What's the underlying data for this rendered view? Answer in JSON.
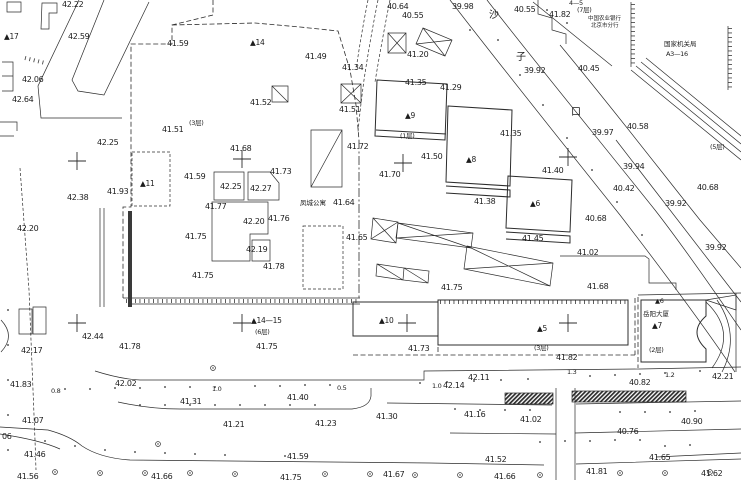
{
  "map_name": "cadastral-survey-site-plan",
  "colors": {
    "ink": "#2c2c2c",
    "background": "#ffffff"
  },
  "street_name_chars": "沙子口",
  "labels": [
    {
      "t": "42.22",
      "x": 62,
      "y": 1
    },
    {
      "t": "42.59",
      "x": 68,
      "y": 33
    },
    {
      "t": "41.59",
      "x": 167,
      "y": 40
    },
    {
      "t": "42.06",
      "x": 22,
      "y": 76
    },
    {
      "t": "42.64",
      "x": 12,
      "y": 96
    },
    {
      "t": "42.25",
      "x": 97,
      "y": 139
    },
    {
      "t": "41.51",
      "x": 162,
      "y": 126
    },
    {
      "t": "(3层)",
      "x": 189,
      "y": 120,
      "c": "fl",
      "n": "floor-count-label"
    },
    {
      "t": "▲17",
      "x": 4,
      "y": 33,
      "c": "bn",
      "n": "building-number-label"
    },
    {
      "t": "▲14",
      "x": 250,
      "y": 39,
      "c": "bn",
      "n": "building-number-label"
    },
    {
      "t": "41.49",
      "x": 305,
      "y": 53
    },
    {
      "t": "41.52",
      "x": 250,
      "y": 99
    },
    {
      "t": "40.64",
      "x": 387,
      "y": 3
    },
    {
      "t": "40.55",
      "x": 402,
      "y": 12
    },
    {
      "t": "39.98",
      "x": 452,
      "y": 3
    },
    {
      "t": "41.34",
      "x": 342,
      "y": 64
    },
    {
      "t": "41.20",
      "x": 407,
      "y": 51
    },
    {
      "t": "41.35",
      "x": 405,
      "y": 79
    },
    {
      "t": "41.29",
      "x": 440,
      "y": 84
    },
    {
      "t": "41.51",
      "x": 339,
      "y": 106
    },
    {
      "t": "41.72",
      "x": 347,
      "y": 143
    },
    {
      "t": "40.55",
      "x": 514,
      "y": 6
    },
    {
      "t": "41.82",
      "x": 549,
      "y": 11
    },
    {
      "t": "4—5",
      "x": 569,
      "y": 0,
      "c": "fl",
      "n": "building-number-label"
    },
    {
      "t": "(7层)",
      "x": 577,
      "y": 7,
      "c": "fl",
      "n": "floor-count-label"
    },
    {
      "t": "中国农业银行",
      "x": 588,
      "y": 17,
      "c": "s5",
      "n": "building-name-label"
    },
    {
      "t": "北京市分行",
      "x": 591,
      "y": 24,
      "c": "s5",
      "n": "building-name-label"
    },
    {
      "t": "国家机关局",
      "x": 664,
      "y": 41,
      "c": "s6",
      "n": "building-name-label"
    },
    {
      "t": "A3—16",
      "x": 666,
      "y": 51,
      "c": "fl",
      "n": "building-number-label"
    },
    {
      "t": "40.45",
      "x": 578,
      "y": 65
    },
    {
      "t": "39.92",
      "x": 524,
      "y": 67
    },
    {
      "t": "沙",
      "x": 489,
      "y": 11,
      "c": "s10",
      "n": "street-name-char"
    },
    {
      "t": "子",
      "x": 516,
      "y": 53,
      "c": "s10",
      "n": "street-name-char"
    },
    {
      "t": "口",
      "x": 571,
      "y": 108,
      "c": "s10",
      "n": "street-name-char"
    },
    {
      "t": "40.58",
      "x": 627,
      "y": 123
    },
    {
      "t": "39.97",
      "x": 592,
      "y": 129
    },
    {
      "t": "(5层)",
      "x": 710,
      "y": 144,
      "c": "fl",
      "n": "floor-count-label"
    },
    {
      "t": "39.94",
      "x": 623,
      "y": 163
    },
    {
      "t": "40.42",
      "x": 613,
      "y": 185
    },
    {
      "t": "40.68",
      "x": 697,
      "y": 184
    },
    {
      "t": "39.92",
      "x": 665,
      "y": 200
    },
    {
      "t": "40.68",
      "x": 585,
      "y": 215
    },
    {
      "t": "39.92",
      "x": 705,
      "y": 244
    },
    {
      "t": "41.02",
      "x": 577,
      "y": 249
    },
    {
      "t": "41.68",
      "x": 587,
      "y": 283
    },
    {
      "t": "41.68",
      "x": 230,
      "y": 145
    },
    {
      "t": "41.73",
      "x": 270,
      "y": 168
    },
    {
      "t": "41.59",
      "x": 184,
      "y": 173
    },
    {
      "t": "42.25",
      "x": 220,
      "y": 183
    },
    {
      "t": "42.27",
      "x": 250,
      "y": 185
    },
    {
      "t": "41.77",
      "x": 205,
      "y": 203
    },
    {
      "t": "42.20",
      "x": 243,
      "y": 218
    },
    {
      "t": "41.75",
      "x": 185,
      "y": 233
    },
    {
      "t": "42.19",
      "x": 246,
      "y": 246
    },
    {
      "t": "41.76",
      "x": 268,
      "y": 215
    },
    {
      "t": "41.78",
      "x": 263,
      "y": 263
    },
    {
      "t": "41.75",
      "x": 192,
      "y": 272
    },
    {
      "t": "41.93",
      "x": 107,
      "y": 188
    },
    {
      "t": "▲11",
      "x": 140,
      "y": 180,
      "c": "bn",
      "n": "building-number-label"
    },
    {
      "t": "42.38",
      "x": 67,
      "y": 194
    },
    {
      "t": "42.20",
      "x": 17,
      "y": 225
    },
    {
      "t": "凤城公寓",
      "x": 300,
      "y": 200,
      "c": "s6",
      "n": "building-name-label"
    },
    {
      "t": "41.64",
      "x": 333,
      "y": 199
    },
    {
      "t": "41.65",
      "x": 346,
      "y": 234
    },
    {
      "t": "41.70",
      "x": 379,
      "y": 171
    },
    {
      "t": "41.50",
      "x": 421,
      "y": 153
    },
    {
      "t": "(1层)",
      "x": 400,
      "y": 133,
      "c": "fl",
      "n": "floor-count-label"
    },
    {
      "t": "▲9",
      "x": 405,
      "y": 112,
      "c": "bn",
      "n": "building-number-label"
    },
    {
      "t": "▲8",
      "x": 466,
      "y": 156,
      "c": "bn",
      "n": "building-number-label"
    },
    {
      "t": "41.38",
      "x": 474,
      "y": 198
    },
    {
      "t": "▲6",
      "x": 530,
      "y": 200,
      "c": "bn",
      "n": "building-number-label"
    },
    {
      "t": "41.40",
      "x": 542,
      "y": 167
    },
    {
      "t": "41.45",
      "x": 522,
      "y": 235
    },
    {
      "t": "41.35",
      "x": 500,
      "y": 130
    },
    {
      "t": "41.75",
      "x": 441,
      "y": 284
    },
    {
      "t": "42.17",
      "x": 21,
      "y": 347
    },
    {
      "t": "42.44",
      "x": 82,
      "y": 333
    },
    {
      "t": "41.78",
      "x": 119,
      "y": 343
    },
    {
      "t": "41.83",
      "x": 10,
      "y": 381
    },
    {
      "t": "42.02",
      "x": 115,
      "y": 380
    },
    {
      "t": "0.8",
      "x": 51,
      "y": 388,
      "c": "fl",
      "n": "distance-label"
    },
    {
      "t": "1.0",
      "x": 212,
      "y": 386,
      "c": "fl",
      "n": "distance-label"
    },
    {
      "t": "41.31",
      "x": 180,
      "y": 398
    },
    {
      "t": "▲14—15",
      "x": 251,
      "y": 317,
      "c": "bn",
      "n": "building-number-label"
    },
    {
      "t": "(6层)",
      "x": 255,
      "y": 329,
      "c": "fl",
      "n": "floor-count-label"
    },
    {
      "t": "41.75",
      "x": 256,
      "y": 343
    },
    {
      "t": "▲10",
      "x": 379,
      "y": 317,
      "c": "bn",
      "n": "building-number-label"
    },
    {
      "t": "41.73",
      "x": 408,
      "y": 345
    },
    {
      "t": "▲5",
      "x": 537,
      "y": 325,
      "c": "bn",
      "n": "building-number-label"
    },
    {
      "t": "(3层)",
      "x": 534,
      "y": 345,
      "c": "fl",
      "n": "floor-count-label"
    },
    {
      "t": "41.82",
      "x": 556,
      "y": 354
    },
    {
      "t": "0.5",
      "x": 337,
      "y": 385,
      "c": "fl",
      "n": "distance-label"
    },
    {
      "t": "1.0",
      "x": 432,
      "y": 383,
      "c": "fl",
      "n": "distance-label"
    },
    {
      "t": "42.14",
      "x": 443,
      "y": 382
    },
    {
      "t": "42.11",
      "x": 468,
      "y": 374
    },
    {
      "t": "41.40",
      "x": 287,
      "y": 394
    },
    {
      "t": "41.30",
      "x": 376,
      "y": 413
    },
    {
      "t": "41.16",
      "x": 464,
      "y": 411
    },
    {
      "t": "41.23",
      "x": 315,
      "y": 420
    },
    {
      "t": "41.07",
      "x": 22,
      "y": 417
    },
    {
      "t": "41.21",
      "x": 223,
      "y": 421
    },
    {
      "t": "06",
      "x": 2,
      "y": 433
    },
    {
      "t": "41.46",
      "x": 24,
      "y": 451
    },
    {
      "t": "41.56",
      "x": 17,
      "y": 473
    },
    {
      "t": "41.66",
      "x": 151,
      "y": 473
    },
    {
      "t": "41.59",
      "x": 287,
      "y": 453
    },
    {
      "t": "41.75",
      "x": 280,
      "y": 474
    },
    {
      "t": "41.67",
      "x": 383,
      "y": 471
    },
    {
      "t": "41.52",
      "x": 485,
      "y": 456
    },
    {
      "t": "41.66",
      "x": 494,
      "y": 473
    },
    {
      "t": "1.3",
      "x": 567,
      "y": 369,
      "c": "fl",
      "n": "distance-label"
    },
    {
      "t": "1.2",
      "x": 665,
      "y": 372,
      "c": "fl",
      "n": "distance-label"
    },
    {
      "t": "42.21",
      "x": 712,
      "y": 373
    },
    {
      "t": "40.82",
      "x": 629,
      "y": 379
    },
    {
      "t": "41.02",
      "x": 520,
      "y": 416
    },
    {
      "t": "40.90",
      "x": 681,
      "y": 418
    },
    {
      "t": "40.76",
      "x": 617,
      "y": 428
    },
    {
      "t": "41.65",
      "x": 649,
      "y": 454
    },
    {
      "t": "41.81",
      "x": 586,
      "y": 468
    },
    {
      "t": "41.62",
      "x": 701,
      "y": 470
    },
    {
      "t": "岳阳大厦",
      "x": 643,
      "y": 311,
      "c": "s6",
      "n": "building-name-label"
    },
    {
      "t": "▲7",
      "x": 652,
      "y": 322,
      "c": "bn",
      "n": "building-number-label"
    },
    {
      "t": "(2层)",
      "x": 649,
      "y": 347,
      "c": "fl",
      "n": "floor-count-label"
    },
    {
      "t": "▲6",
      "x": 655,
      "y": 298,
      "c": "fl",
      "n": "building-number-label"
    }
  ],
  "crosses": [
    [
      77,
      161
    ],
    [
      242,
      159
    ],
    [
      403,
      163
    ],
    [
      568,
      157
    ],
    [
      77,
      323
    ],
    [
      242,
      323
    ],
    [
      407,
      323
    ],
    [
      568,
      323
    ]
  ],
  "dots": [
    [
      65,
      389
    ],
    [
      90,
      389
    ],
    [
      115,
      388
    ],
    [
      140,
      388
    ],
    [
      165,
      387
    ],
    [
      190,
      387
    ],
    [
      215,
      387
    ],
    [
      255,
      386
    ],
    [
      280,
      386
    ],
    [
      305,
      385
    ],
    [
      330,
      385
    ],
    [
      420,
      383
    ],
    [
      447,
      382
    ],
    [
      474,
      381
    ],
    [
      501,
      380
    ],
    [
      528,
      379
    ],
    [
      590,
      376
    ],
    [
      615,
      375
    ],
    [
      640,
      374
    ],
    [
      665,
      373
    ],
    [
      700,
      371
    ],
    [
      140,
      405
    ],
    [
      165,
      405
    ],
    [
      190,
      405
    ],
    [
      215,
      405
    ],
    [
      240,
      405
    ],
    [
      265,
      405
    ],
    [
      290,
      405
    ],
    [
      315,
      405
    ],
    [
      455,
      409
    ],
    [
      480,
      410
    ],
    [
      505,
      410
    ],
    [
      530,
      410
    ],
    [
      620,
      412
    ],
    [
      645,
      412
    ],
    [
      670,
      412
    ],
    [
      695,
      411
    ],
    [
      45,
      441
    ],
    [
      75,
      446
    ],
    [
      105,
      450
    ],
    [
      135,
      452
    ],
    [
      165,
      453
    ],
    [
      195,
      454
    ],
    [
      225,
      455
    ],
    [
      285,
      456
    ],
    [
      540,
      442
    ],
    [
      565,
      441
    ],
    [
      590,
      441
    ],
    [
      615,
      440
    ],
    [
      640,
      440
    ],
    [
      665,
      446
    ],
    [
      690,
      445
    ],
    [
      498,
      40
    ],
    [
      520,
      75
    ],
    [
      543,
      105
    ],
    [
      567,
      138
    ],
    [
      592,
      170
    ],
    [
      617,
      202
    ],
    [
      642,
      235
    ],
    [
      470,
      30
    ],
    [
      547,
      10
    ],
    [
      567,
      23
    ],
    [
      8,
      310
    ],
    [
      8,
      345
    ],
    [
      8,
      380
    ],
    [
      8,
      415
    ],
    [
      8,
      450
    ]
  ],
  "trees": [
    [
      55,
      472
    ],
    [
      100,
      473
    ],
    [
      145,
      473
    ],
    [
      190,
      473
    ],
    [
      235,
      474
    ],
    [
      325,
      474
    ],
    [
      370,
      474
    ],
    [
      415,
      475
    ],
    [
      460,
      475
    ],
    [
      540,
      475
    ],
    [
      620,
      473
    ],
    [
      665,
      473
    ],
    [
      710,
      472
    ],
    [
      213,
      368
    ],
    [
      158,
      444
    ]
  ]
}
